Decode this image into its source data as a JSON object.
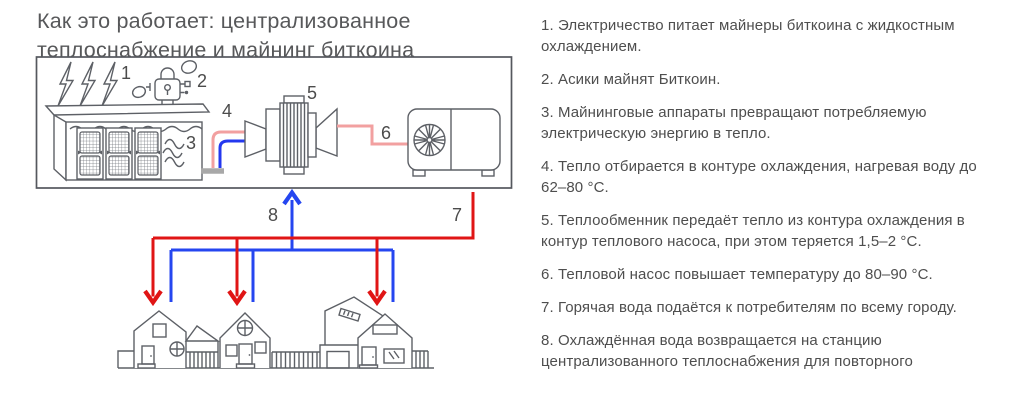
{
  "title": "Как это работает: централизованное теплоснабжение и майнинг биткоина",
  "steps": [
    "1. Электричество питает майнеры биткоина с жидкостным охлаждением.",
    "2. Асики майнят Биткоин.",
    "3. Майнинговые аппараты превращают потребляемую электрическую энергию в тепло.",
    "4. Тепло отбирается в контуре охлаждения, нагревая воду до 62–80 °C.",
    "5. Теплообменник передаёт тепло из контура охлаждения в контур теплового насоса, при этом теряется 1,5–2 °C.",
    "6. Тепловой насос повышает температуру до 80–90 °C.",
    "7. Горячая вода подаётся к потребителям по всему городу.",
    "8. Охлаждённая вода возвращается на станцию централизованного теплоснабжения для повторного"
  ],
  "diagram": {
    "labels": [
      "1",
      "2",
      "3",
      "4",
      "5",
      "6",
      "7",
      "8"
    ],
    "icons": [
      "lightning-icon",
      "bitcoin-lock-icon",
      "immersion-miners-icon",
      "heat-exchanger-icon",
      "heat-pump-fan-icon",
      "houses-icon"
    ]
  },
  "colors": {
    "line": "#5d6066",
    "supply_red": "#e01515",
    "pipe_pink": "#f2a0a0",
    "return_blue": "#2546f0",
    "pipe_stub_gray": "#a8a8a8",
    "text": "#4e4e4e"
  }
}
